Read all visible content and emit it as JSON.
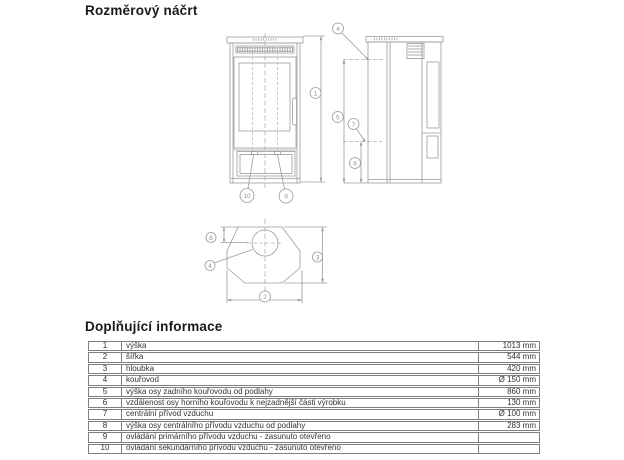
{
  "page": {
    "drawing_title": "Rozměrový náčrt",
    "info_title": "Doplňující informace"
  },
  "drawing": {
    "callouts": {
      "c1": "1",
      "c2": "2",
      "c3": "3",
      "c4": "4",
      "c5": "5",
      "c6": "6",
      "c7": "7",
      "c8": "8",
      "c9": "9",
      "c10": "10"
    }
  },
  "table": {
    "rows": [
      {
        "num": "1",
        "label": "výška",
        "value": "1013 mm"
      },
      {
        "num": "2",
        "label": "šířka",
        "value": "544 mm"
      },
      {
        "num": "3",
        "label": "hloubka",
        "value": "420 mm"
      },
      {
        "num": "4",
        "label": "kouřovod",
        "value": "Ø 150 mm"
      },
      {
        "num": "5",
        "label": "výška osy zadního kouřovodu od podlahy",
        "value": "860 mm"
      },
      {
        "num": "6",
        "label": "vzdálenost osy horního kouřovodu k nejzadnější části výrobku",
        "value": "130 mm"
      },
      {
        "num": "7",
        "label": "centrální přívod vzduchu",
        "value": "Ø 100 mm"
      },
      {
        "num": "8",
        "label": "výška osy centrálního přívodu vzduchu od podlahy",
        "value": "283 mm"
      },
      {
        "num": "9",
        "label": "ovládání primárního přívodu vzduchu - zasunuto otevřeno",
        "value": ""
      },
      {
        "num": "10",
        "label": "ovládání sekundárního přívodu vzduchu - zasunuto otevřeno",
        "value": ""
      }
    ]
  },
  "colors": {
    "line": "#9b9b9b",
    "dash": "#b0b0b0",
    "callout_text": "#8f9598",
    "table_border": "#7f7f7f",
    "title_text": "#191919"
  }
}
